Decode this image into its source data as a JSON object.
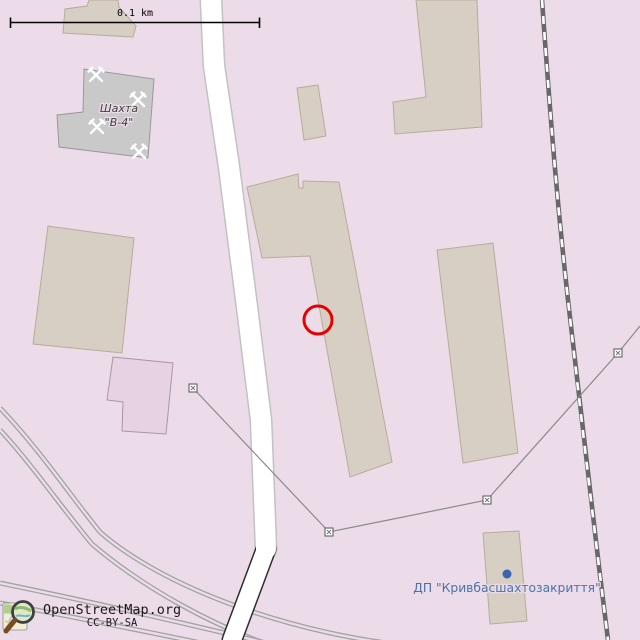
{
  "map": {
    "scale_bar_label": "0.1 km",
    "labels": {
      "mine_line1": "Шахта",
      "mine_line2": "\"В-4\"",
      "enterprise": "ДП \"Кривбасшахтозакриття\""
    },
    "attribution": {
      "site": "OpenStreetMap.org",
      "license": "CC-BY-SA"
    },
    "colors": {
      "background": "#ecdcea",
      "building": "#d7cfc4",
      "building_outline": "#b9ab99",
      "building_gray": "#c9c9c9",
      "building_purple": "#e6d2e2",
      "road_fill": "#ffffff",
      "railway": "#686868",
      "disused_rail": "#a2a2a2",
      "fence": "#8a8a8a",
      "marker": "#e60000",
      "poi_label": "#4a72aa",
      "poi_dot": "#3b63ae"
    }
  }
}
